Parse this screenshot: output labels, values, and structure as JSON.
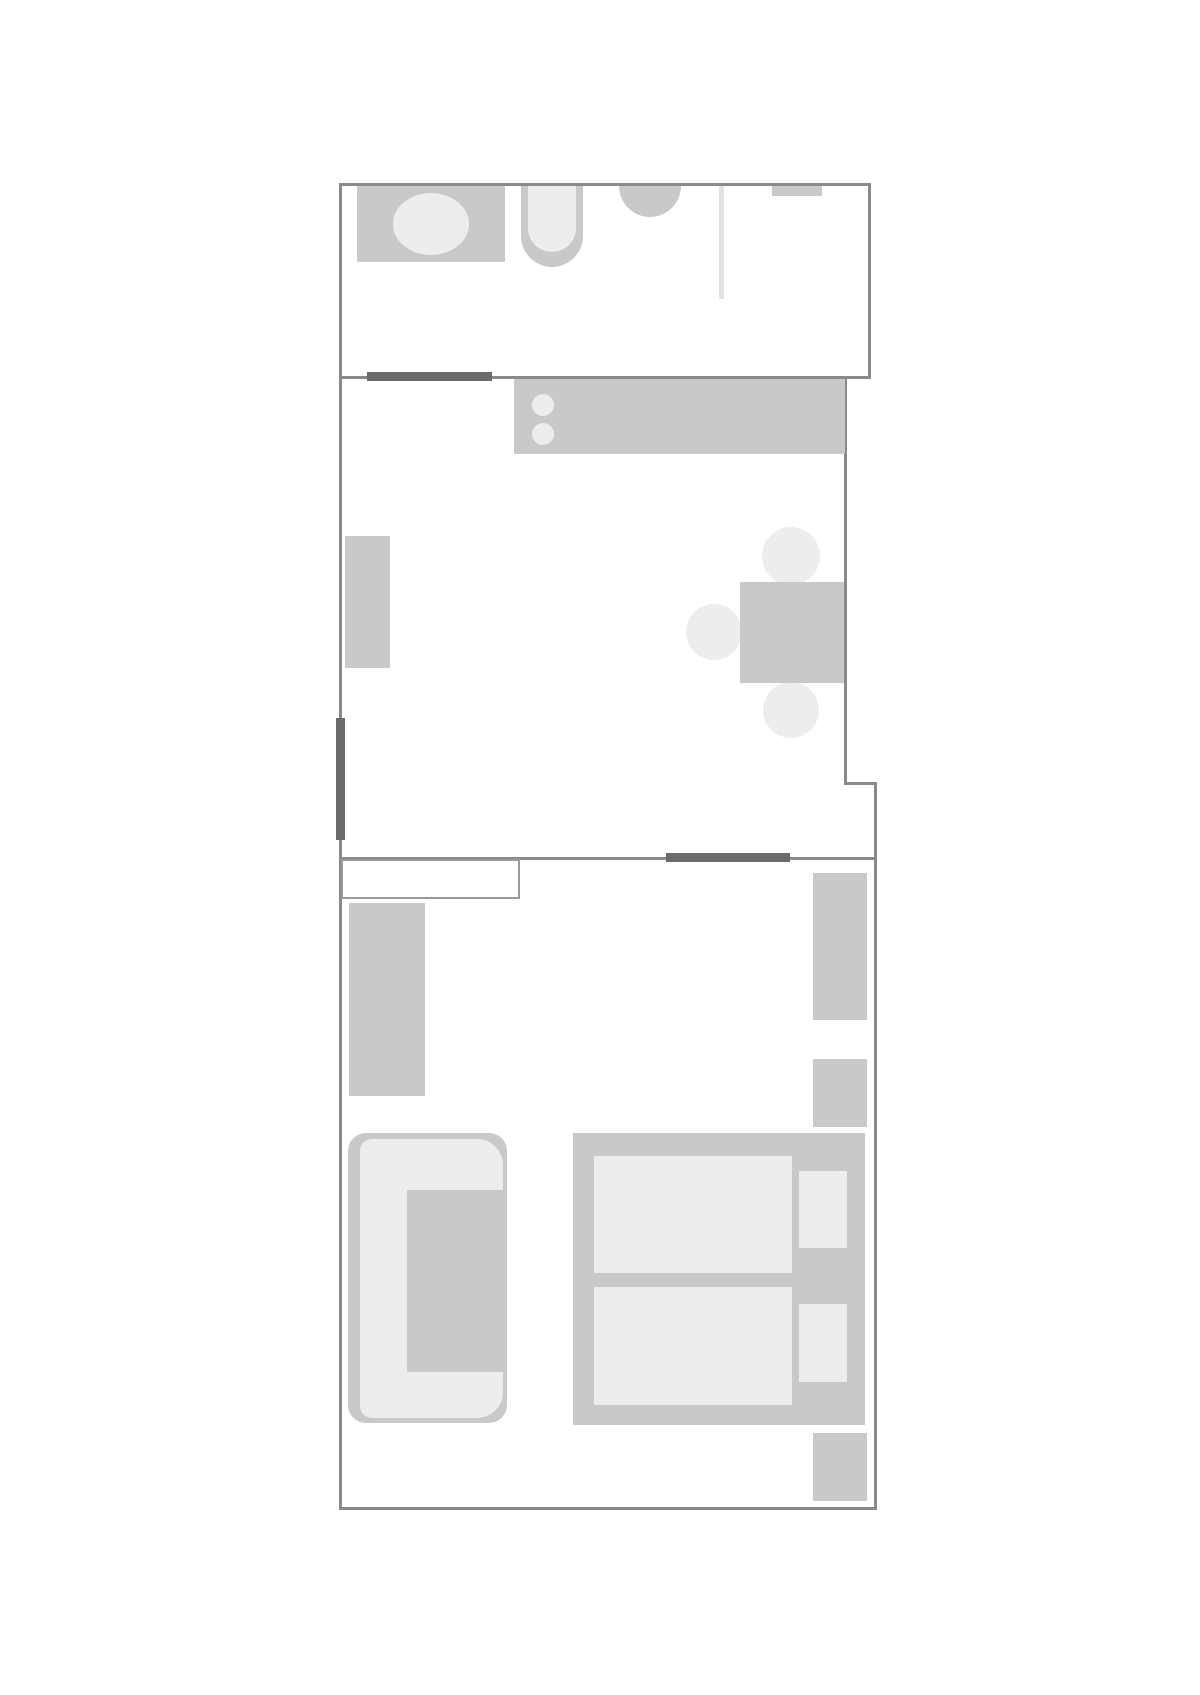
{
  "page": {
    "width": 1200,
    "height": 1695,
    "background": "#ffffff",
    "description_name": "apartment-floor-plan"
  },
  "palette": {
    "wall": "#8a8a8a",
    "wall_light": "#9a9a9a",
    "door": "#6b6b6b",
    "furniture": "#c9c9c9",
    "furniture_light": "#ededed",
    "divider": "#e3e3e3",
    "floor": "#ffffff"
  },
  "rooms": [
    {
      "name": "bathroom"
    },
    {
      "name": "kitchen-living-room"
    },
    {
      "name": "bedroom"
    }
  ],
  "elements": [
    {
      "name": "outer-left-wall",
      "room": "shell",
      "shape": "rect",
      "x": 339,
      "y": 183,
      "w": 3,
      "h": 1327,
      "fill": "wall"
    },
    {
      "name": "bathroom-top-wall",
      "room": "bathroom",
      "shape": "rect",
      "x": 339,
      "y": 183,
      "w": 532,
      "h": 3,
      "fill": "wall"
    },
    {
      "name": "bathroom-right-wall",
      "room": "bathroom",
      "shape": "rect",
      "x": 868,
      "y": 183,
      "w": 3,
      "h": 196,
      "fill": "wall"
    },
    {
      "name": "bathroom-bottom-wall",
      "room": "bathroom",
      "shape": "rect",
      "x": 339,
      "y": 376,
      "w": 532,
      "h": 3,
      "fill": "wall"
    },
    {
      "name": "kitchen-right-wall",
      "room": "kitchen-living-room",
      "shape": "rect",
      "x": 844,
      "y": 376,
      "w": 3,
      "h": 408,
      "fill": "wall"
    },
    {
      "name": "kitchen-step-wall",
      "room": "kitchen-living-room",
      "shape": "rect",
      "x": 844,
      "y": 782,
      "w": 33,
      "h": 3,
      "fill": "wall"
    },
    {
      "name": "lower-right-wall",
      "room": "shell",
      "shape": "rect",
      "x": 874,
      "y": 782,
      "w": 3,
      "h": 728,
      "fill": "wall"
    },
    {
      "name": "bedroom-top-wall",
      "room": "bedroom",
      "shape": "rect",
      "x": 339,
      "y": 857,
      "w": 538,
      "h": 3,
      "fill": "wall"
    },
    {
      "name": "outer-bottom-wall",
      "room": "bedroom",
      "shape": "rect",
      "x": 339,
      "y": 1507,
      "w": 538,
      "h": 3,
      "fill": "wall"
    },
    {
      "name": "bathroom-door-marker",
      "room": "bathroom",
      "shape": "rect",
      "x": 367,
      "y": 372,
      "w": 125,
      "h": 9,
      "fill": "door"
    },
    {
      "name": "kitchen-left-door-marker",
      "room": "kitchen-living-room",
      "shape": "rect",
      "x": 336,
      "y": 718,
      "w": 9,
      "h": 122,
      "fill": "door"
    },
    {
      "name": "bedroom-door-marker",
      "room": "bedroom",
      "shape": "rect",
      "x": 666,
      "y": 853,
      "w": 124,
      "h": 9,
      "fill": "door"
    },
    {
      "name": "vanity-counter",
      "room": "bathroom",
      "shape": "rect",
      "x": 357,
      "y": 186,
      "w": 148,
      "h": 76,
      "fill": "furniture"
    },
    {
      "name": "vanity-sink-basin",
      "room": "bathroom",
      "shape": "rect",
      "x": 393,
      "y": 193,
      "w": 76,
      "h": 62,
      "fill": "furniture_light",
      "radius": "50%"
    },
    {
      "name": "toilet-bowl-outer",
      "room": "bathroom",
      "shape": "rect",
      "x": 521,
      "y": 186,
      "w": 62,
      "h": 81,
      "fill": "furniture",
      "radius": "0 0 31px 31px"
    },
    {
      "name": "toilet-bowl-inner",
      "room": "bathroom",
      "shape": "rect",
      "x": 528,
      "y": 186,
      "w": 48,
      "h": 66,
      "fill": "furniture_light",
      "radius": "0 0 24px 24px"
    },
    {
      "name": "corner-washbasin",
      "room": "bathroom",
      "shape": "rect",
      "x": 619,
      "y": 186,
      "w": 62,
      "h": 31,
      "fill": "furniture",
      "radius": "0 0 62px 62px"
    },
    {
      "name": "shower-screen-divider",
      "room": "bathroom",
      "shape": "rect",
      "x": 719,
      "y": 186,
      "w": 5,
      "h": 113,
      "fill": "divider"
    },
    {
      "name": "bathroom-wall-shelf",
      "room": "bathroom",
      "shape": "rect",
      "x": 772,
      "y": 186,
      "w": 50,
      "h": 10,
      "fill": "furniture"
    },
    {
      "name": "kitchen-counter",
      "room": "kitchen-living-room",
      "shape": "rect",
      "x": 514,
      "y": 379,
      "w": 331,
      "h": 75,
      "fill": "furniture"
    },
    {
      "name": "kitchen-sink-burner-top",
      "room": "kitchen-living-room",
      "shape": "circle",
      "x": 532,
      "y": 394,
      "w": 22,
      "h": 22,
      "fill": "furniture_light"
    },
    {
      "name": "kitchen-sink-burner-bottom",
      "room": "kitchen-living-room",
      "shape": "circle",
      "x": 532,
      "y": 423,
      "w": 22,
      "h": 22,
      "fill": "furniture_light"
    },
    {
      "name": "kitchen-side-cabinet",
      "room": "kitchen-living-room",
      "shape": "rect",
      "x": 345,
      "y": 536,
      "w": 45,
      "h": 132,
      "fill": "furniture"
    },
    {
      "name": "dining-chair-top",
      "room": "kitchen-living-room",
      "shape": "circle",
      "x": 762,
      "y": 527,
      "w": 58,
      "h": 58,
      "fill": "furniture_light"
    },
    {
      "name": "dining-chair-left",
      "room": "kitchen-living-room",
      "shape": "circle",
      "x": 686,
      "y": 604,
      "w": 56,
      "h": 56,
      "fill": "furniture_light"
    },
    {
      "name": "dining-chair-bottom",
      "room": "kitchen-living-room",
      "shape": "circle",
      "x": 763,
      "y": 682,
      "w": 56,
      "h": 56,
      "fill": "furniture_light"
    },
    {
      "name": "dining-table",
      "room": "kitchen-living-room",
      "shape": "rect",
      "x": 740,
      "y": 582,
      "w": 104,
      "h": 101,
      "fill": "furniture"
    },
    {
      "name": "bedroom-closet-niche",
      "room": "bedroom",
      "shape": "rect",
      "x": 341,
      "y": 859,
      "w": 179,
      "h": 40,
      "fill": "floor",
      "border": "2px solid #9a9a9a"
    },
    {
      "name": "wardrobe-left",
      "room": "bedroom",
      "shape": "rect",
      "x": 349,
      "y": 903,
      "w": 76,
      "h": 193,
      "fill": "furniture"
    },
    {
      "name": "wardrobe-right",
      "room": "bedroom",
      "shape": "rect",
      "x": 813,
      "y": 873,
      "w": 54,
      "h": 147,
      "fill": "furniture"
    },
    {
      "name": "nightstand-top",
      "room": "bedroom",
      "shape": "rect",
      "x": 813,
      "y": 1059,
      "w": 54,
      "h": 68,
      "fill": "furniture"
    },
    {
      "name": "sofa-base",
      "room": "bedroom",
      "shape": "rect",
      "x": 348,
      "y": 1133,
      "w": 159,
      "h": 290,
      "fill": "furniture",
      "radius": "18px"
    },
    {
      "name": "sofa-cushions",
      "room": "bedroom",
      "shape": "rect",
      "x": 360,
      "y": 1139,
      "w": 143,
      "h": 279,
      "fill": "furniture_light",
      "radius": "12px 26px 26px 12px"
    },
    {
      "name": "sofa-backrest",
      "room": "bedroom",
      "shape": "rect",
      "x": 407,
      "y": 1190,
      "w": 100,
      "h": 182,
      "fill": "furniture"
    },
    {
      "name": "double-bed-base",
      "room": "bedroom",
      "shape": "rect",
      "x": 573,
      "y": 1133,
      "w": 292,
      "h": 292,
      "fill": "furniture"
    },
    {
      "name": "mattress-top",
      "room": "bedroom",
      "shape": "rect",
      "x": 594,
      "y": 1156,
      "w": 198,
      "h": 117,
      "fill": "furniture_light"
    },
    {
      "name": "mattress-bottom",
      "room": "bedroom",
      "shape": "rect",
      "x": 594,
      "y": 1287,
      "w": 198,
      "h": 118,
      "fill": "furniture_light"
    },
    {
      "name": "pillow-top",
      "room": "bedroom",
      "shape": "rect",
      "x": 799,
      "y": 1171,
      "w": 48,
      "h": 77,
      "fill": "furniture_light"
    },
    {
      "name": "pillow-bottom",
      "room": "bedroom",
      "shape": "rect",
      "x": 799,
      "y": 1304,
      "w": 48,
      "h": 78,
      "fill": "furniture_light"
    },
    {
      "name": "nightstand-bottom",
      "room": "bedroom",
      "shape": "rect",
      "x": 813,
      "y": 1433,
      "w": 54,
      "h": 68,
      "fill": "furniture"
    }
  ]
}
